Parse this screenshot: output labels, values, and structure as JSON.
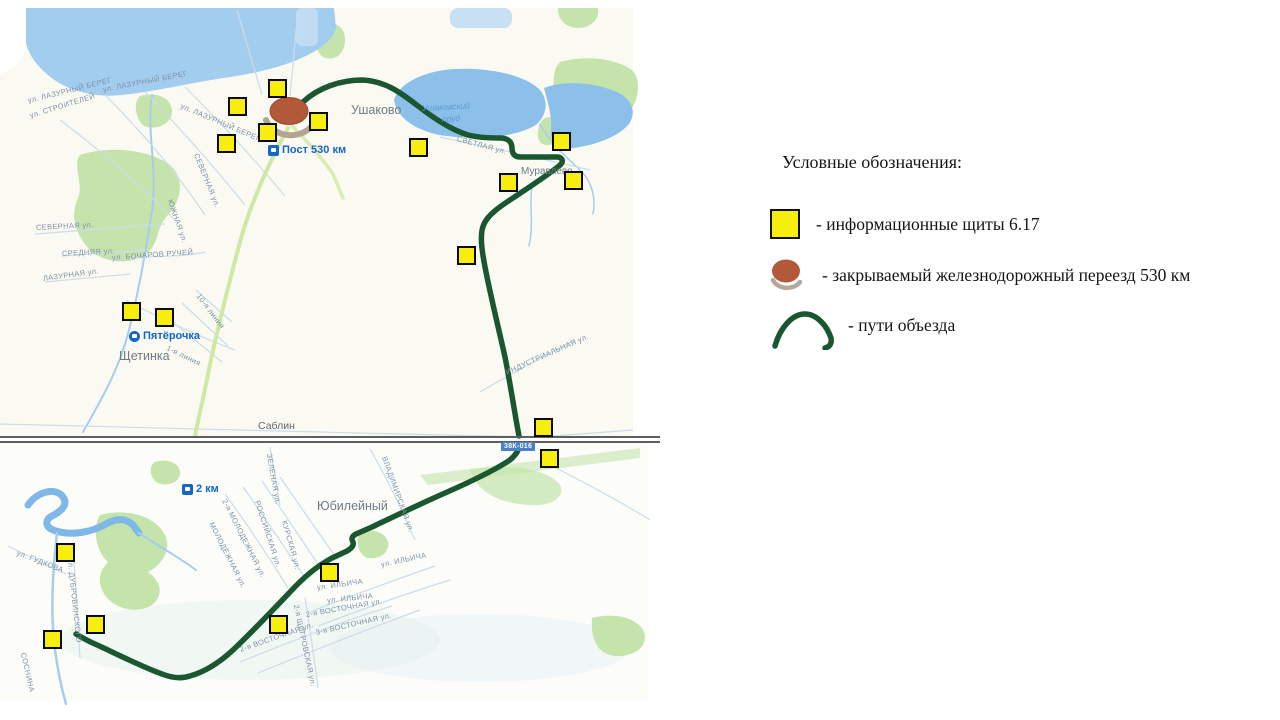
{
  "colors": {
    "board-yellow": "#F8EE0D",
    "route-green": "#1A5730",
    "crossing-brown": "#B2593A",
    "crossing-shadow": "#B3A395",
    "water-blue": "#A3CDEF",
    "pond-blue": "#8CC0EA",
    "forest-green": "#C5E4AC",
    "road-green": "#CFE8A3",
    "street-label": "#7D92A8",
    "place-label": "#6E7B87",
    "poi-blue": "#1566C8",
    "badge-blue": "#4A80C4",
    "seam-gray": "#5E5E5E",
    "land-top": "#FBFAF2",
    "land-bottom": "#FCFDF9"
  },
  "legend": {
    "title": "Условные обозначения:",
    "items": [
      {
        "id": "info-boards",
        "label": "- информационные щиты 6.17"
      },
      {
        "id": "railway-crossing",
        "label": "- закрываемый железнодорожный переезд 530 км"
      },
      {
        "id": "detour-routes",
        "label": "- пути объезда"
      }
    ]
  },
  "map": {
    "info_markers": [
      [
        277,
        88
      ],
      [
        237,
        106
      ],
      [
        267,
        132
      ],
      [
        226,
        143
      ],
      [
        318,
        121
      ],
      [
        418,
        147
      ],
      [
        561,
        141
      ],
      [
        573,
        180
      ],
      [
        508,
        182
      ],
      [
        466,
        255
      ],
      [
        131,
        311
      ],
      [
        164,
        317
      ],
      [
        543,
        427
      ],
      [
        549,
        458
      ],
      [
        329,
        572
      ],
      [
        278,
        624
      ],
      [
        65,
        552
      ],
      [
        95,
        624
      ],
      [
        52,
        639
      ]
    ],
    "labels": [
      {
        "text": "ул. ЛАЗУРНЫЙ БЕРЕГ",
        "x": 28,
        "y": 97,
        "rot": -14,
        "cls": "street"
      },
      {
        "text": "ул. ЛАЗУРНЫЙ БЕРЕГ",
        "x": 103,
        "y": 86,
        "rot": -11,
        "cls": "street"
      },
      {
        "text": "ул. ЛАЗУРНЫЙ БЕРЕГ",
        "x": 181,
        "y": 102,
        "rot": 23,
        "cls": "street"
      },
      {
        "text": "ул. СТРОИТЕЛЕЙ",
        "x": 30,
        "y": 112,
        "rot": -17,
        "cls": "street"
      },
      {
        "text": "СЕВЕРНАЯ ул.",
        "x": 36,
        "y": 224,
        "rot": -3,
        "cls": "street"
      },
      {
        "text": "СЕВЕРНАЯ ул.",
        "x": 196,
        "y": 150,
        "rot": 68,
        "cls": "street"
      },
      {
        "text": "ЮЖНАЯ ул.",
        "x": 170,
        "y": 196,
        "rot": 71,
        "cls": "street"
      },
      {
        "text": "СРЕДНЯЯ ул.",
        "x": 62,
        "y": 250,
        "rot": -3,
        "cls": "street"
      },
      {
        "text": "ул. БОЧАРОВ РУЧЕЙ",
        "x": 112,
        "y": 254,
        "rot": -4,
        "cls": "street"
      },
      {
        "text": "ЛАЗУРНАЯ ул.",
        "x": 43,
        "y": 275,
        "rot": -8,
        "cls": "street"
      },
      {
        "text": "10-я линия",
        "x": 198,
        "y": 291,
        "rot": 53,
        "cls": "street"
      },
      {
        "text": "1-я линия",
        "x": 167,
        "y": 344,
        "rot": 26,
        "cls": "street"
      },
      {
        "text": "СВЕТЛАЯ ул.",
        "x": 457,
        "y": 135,
        "rot": 15,
        "cls": "street"
      },
      {
        "text": "ИНДУСТРИАЛЬНАЯ ул.",
        "x": 506,
        "y": 369,
        "rot": -24,
        "cls": "street"
      },
      {
        "text": "ЗЕЛЕНАЯ ул.",
        "x": 269,
        "y": 450,
        "rot": 80,
        "cls": "street"
      },
      {
        "text": "ВЛАДИМИРСКАЯ ул.",
        "x": 384,
        "y": 453,
        "rot": 70,
        "cls": "street"
      },
      {
        "text": "2-я МОЛОДЕЖНАЯ ул.",
        "x": 224,
        "y": 496,
        "rot": 63,
        "cls": "street"
      },
      {
        "text": "МОЛОДЁЖНАЯ ул.",
        "x": 211,
        "y": 519,
        "rot": 63,
        "cls": "street"
      },
      {
        "text": "РОССИЙСКАЯ ул.",
        "x": 257,
        "y": 497,
        "rot": 72,
        "cls": "street"
      },
      {
        "text": "КУРСКАЯ ул.",
        "x": 284,
        "y": 517,
        "rot": 74,
        "cls": "street"
      },
      {
        "text": "ул. ИЛЬИЧА",
        "x": 381,
        "y": 561,
        "rot": -12,
        "cls": "street"
      },
      {
        "text": "ул. ИЛЬИЧА",
        "x": 317,
        "y": 584,
        "rot": -8,
        "cls": "street"
      },
      {
        "text": "ул. ИЛЬИЧА",
        "x": 327,
        "y": 597,
        "rot": -6,
        "cls": "street"
      },
      {
        "text": "2-я ВОСТОЧНАЯ ул.",
        "x": 306,
        "y": 611,
        "rot": -10,
        "cls": "street"
      },
      {
        "text": "3-я ВОСТОЧНАЯ ул.",
        "x": 316,
        "y": 629,
        "rot": -13,
        "cls": "street"
      },
      {
        "text": "2-я ВОСТОЧНАЯ ул.",
        "x": 240,
        "y": 646,
        "rot": -19,
        "cls": "street"
      },
      {
        "text": "2-я ЩИГРОВСКАЯ ул.",
        "x": 296,
        "y": 601,
        "rot": 78,
        "cls": "street"
      },
      {
        "text": "ул. ГУДКОВА",
        "x": 17,
        "y": 549,
        "rot": 21,
        "cls": "street"
      },
      {
        "text": "ул. ДУБРОВИНСКОГО",
        "x": 70,
        "y": 555,
        "rot": 84,
        "cls": "street"
      },
      {
        "text": "СОСНИНА",
        "x": 23,
        "y": 649,
        "rot": 77,
        "cls": "street"
      },
      {
        "text": "Ушаково",
        "x": 351,
        "y": 104,
        "rot": 0,
        "cls": "place"
      },
      {
        "text": "Щетинка",
        "x": 119,
        "y": 350,
        "rot": 0,
        "cls": "place"
      },
      {
        "text": "Юбилейный",
        "x": 317,
        "y": 500,
        "rot": 0,
        "cls": "place"
      },
      {
        "text": "Саблин",
        "x": 258,
        "y": 421,
        "rot": 0,
        "cls": "place small"
      },
      {
        "text": "Муравлево",
        "x": 521,
        "y": 167,
        "rot": 0,
        "cls": "place tiny"
      },
      {
        "text": "Ушаковский",
        "x": 422,
        "y": 104,
        "rot": -3,
        "cls": "water"
      },
      {
        "text": "пруд",
        "x": 442,
        "y": 115,
        "rot": -3,
        "cls": "water"
      },
      {
        "text": "Пост 530 км",
        "x": 268,
        "y": 145,
        "rot": 0,
        "cls": "poi",
        "icon": "square"
      },
      {
        "text": "Пятёрочка",
        "x": 129,
        "y": 331,
        "rot": 0,
        "cls": "poi",
        "icon": "circle"
      },
      {
        "text": "2 км",
        "x": 182,
        "y": 484,
        "rot": 0,
        "cls": "poi",
        "icon": "square"
      },
      {
        "text": "38К-016",
        "x": 501,
        "y": 442,
        "rot": 0,
        "cls": "badge"
      }
    ]
  }
}
